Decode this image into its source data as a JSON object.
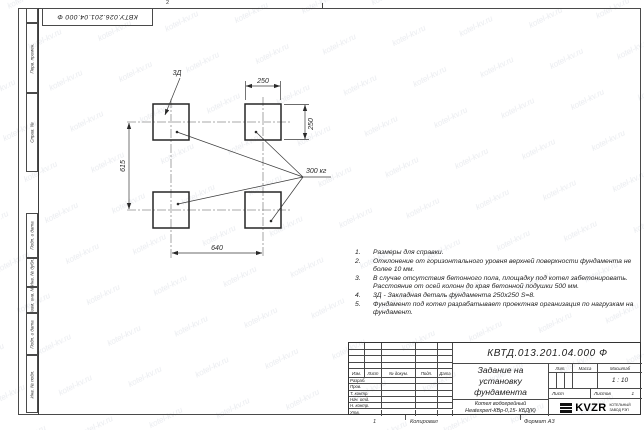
{
  "sheet": {
    "watermark": "kotel-kv.ru",
    "zone_number": "2",
    "top_doc_number": "КВТУ.026.201.04.000 Ф",
    "footer": {
      "copy_number": "1",
      "copied": "Копировал",
      "format": "Формат А3"
    }
  },
  "margin_stamps": {
    "top": [
      "Перв. примен.",
      "Справ. №"
    ],
    "bottom": [
      "Подп. и дата",
      "Инв. № дубл.",
      "Взам. инв. №",
      "Подп. и дата",
      "Инв. № подл."
    ]
  },
  "drawing": {
    "embed_label": "3Д",
    "load_label": "300 кг",
    "dims": {
      "pad_width": "250",
      "pad_height": "250",
      "span_vertical": "615",
      "span_horizontal": "640"
    }
  },
  "notes": {
    "items": [
      {
        "num": "1.",
        "text": "Размеры для справки."
      },
      {
        "num": "2.",
        "text": "Отклонение от горизонтального уровня верхней поверхности фундамента не более 10 мм."
      },
      {
        "num": "3.",
        "text": "В случае отсутствия бетонного пола, площадку под котел забетонировать. Расстояние от осей колонн до края бетонной подушки 500 мм."
      },
      {
        "num": "4.",
        "text": "3Д - Закладная деталь фундамента 250х250 S=8."
      },
      {
        "num": "5.",
        "text": "Фундамент под котел разрабатывает проектная организация по нагрузкам на фундамент."
      }
    ]
  },
  "title_block": {
    "doc_number": "КВТД.013.201.04.000 Ф",
    "title": "Задание на установку фундамента",
    "product_line1": "Котел водогрейный",
    "product_line2": "Heatexpert-КВр-0,15- КБД(К)",
    "header_columns": [
      "Изм.",
      "Лист",
      "№ докум.",
      "Подп.",
      "Дата"
    ],
    "signature_rows": [
      "Разраб.",
      "Пров.",
      "Т. контр.",
      "Нач. отд.",
      "Н. контр.",
      "Утв."
    ],
    "lit_label": "Лит.",
    "mass_label": "Масса",
    "scale_label": "Масштаб",
    "scale_value": "1 : 10",
    "sheet_label": "Лист",
    "sheets_label": "Листов",
    "sheets_value": "1",
    "logo_text": "KVZR",
    "logo_caption_line1": "КОТЕЛЬНЫЙ",
    "logo_caption_line2": "ЗАВОД РЭП"
  }
}
